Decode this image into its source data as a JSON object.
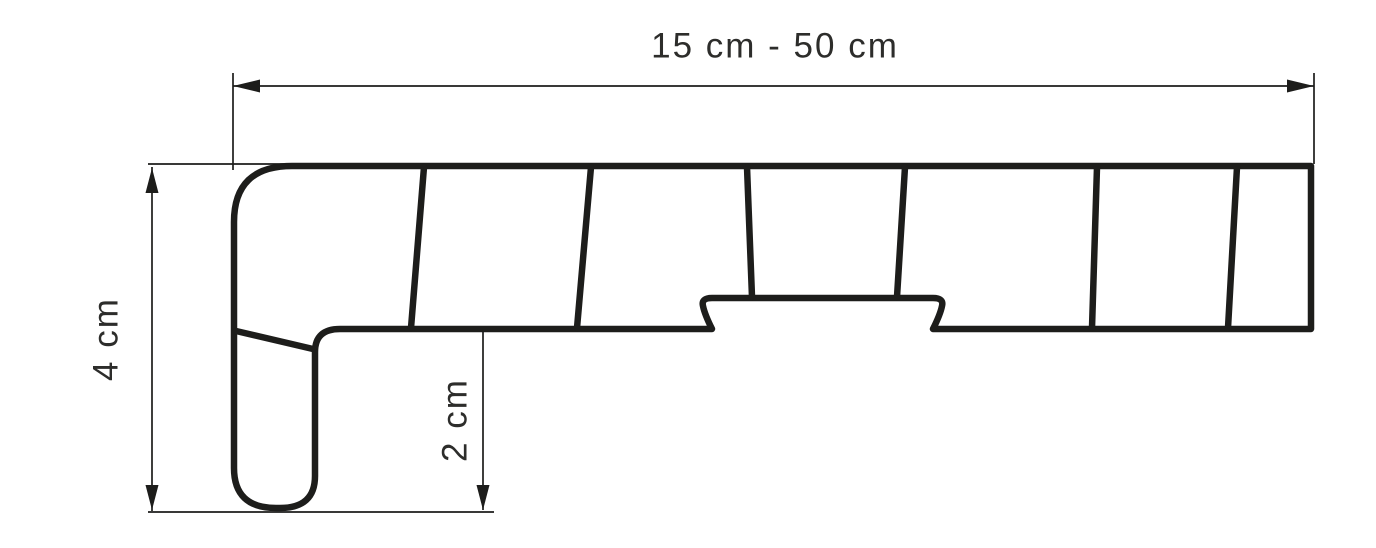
{
  "colors": {
    "line": "#1d1d1b",
    "text": "#2d2d2b",
    "background": "#ffffff"
  },
  "labels": {
    "width_range": "15 cm - 50 cm",
    "height_total": "4 cm",
    "nose_drop": "2 cm"
  }
}
